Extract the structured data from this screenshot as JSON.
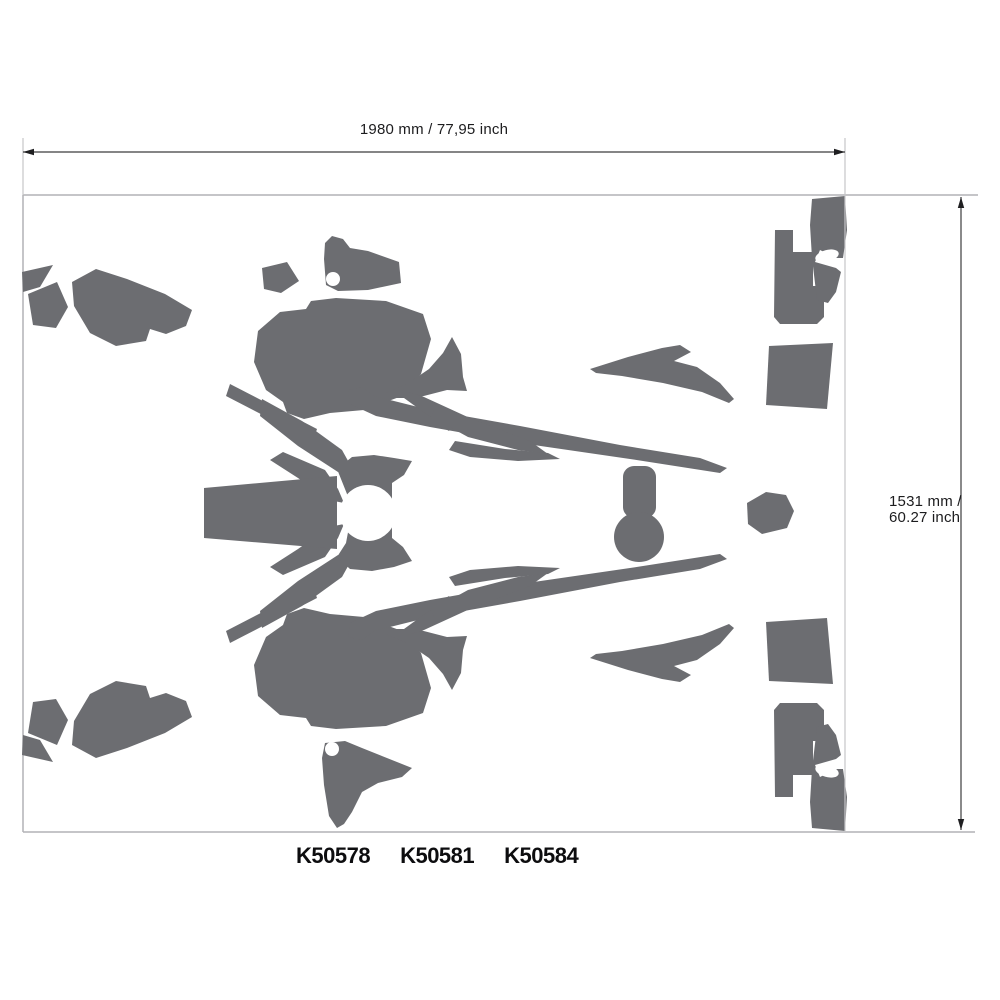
{
  "colors": {
    "decal": "#6c6d71",
    "sheet_border": "#b2b2b5",
    "ext_line": "#c6c6c8",
    "dim_line": "#3c3c3e",
    "arrow": "#1f1f21",
    "text": "#1c1c1e"
  },
  "sheet": {
    "x": 23,
    "y": 195,
    "w": 955,
    "h": 637
  },
  "dimensions": {
    "width": {
      "label": "1980 mm / 77,95 inch",
      "line": {
        "x1": 23,
        "y1": 152,
        "x2": 845,
        "y2": 152
      },
      "extensions": [
        {
          "x1": 23,
          "y1": 138,
          "x2": 23,
          "y2": 195
        },
        {
          "x1": 845,
          "y1": 138,
          "x2": 845,
          "y2": 831
        }
      ]
    },
    "height": {
      "label_line1": "1531 mm /",
      "label_line2": "60.27 inch",
      "line": {
        "x1": 961,
        "y1": 197,
        "x2": 961,
        "y2": 830
      }
    }
  },
  "part_numbers": [
    "K50578",
    "K50581",
    "K50584"
  ],
  "decal_shapes": [
    {
      "name": "left-tri",
      "type": "polygon",
      "mirror": true,
      "points": [
        [
          22,
          272
        ],
        [
          53,
          265
        ],
        [
          40,
          287
        ],
        [
          23,
          292
        ]
      ]
    },
    {
      "name": "left-quad",
      "type": "polygon",
      "mirror": true,
      "points": [
        [
          28,
          294
        ],
        [
          57,
          282
        ],
        [
          68,
          307
        ],
        [
          56,
          328
        ],
        [
          33,
          325
        ]
      ]
    },
    {
      "name": "left-fender",
      "type": "polygon",
      "mirror": true,
      "points": [
        [
          72,
          282
        ],
        [
          96,
          269
        ],
        [
          127,
          279
        ],
        [
          165,
          294
        ],
        [
          192,
          310
        ],
        [
          186,
          326
        ],
        [
          166,
          334
        ],
        [
          150,
          329
        ],
        [
          146,
          341
        ],
        [
          116,
          346
        ],
        [
          90,
          333
        ],
        [
          74,
          306
        ]
      ]
    },
    {
      "name": "mid-quad",
      "type": "polygon",
      "mirror": false,
      "points": [
        [
          262,
          268
        ],
        [
          287,
          262
        ],
        [
          299,
          281
        ],
        [
          281,
          293
        ],
        [
          264,
          289
        ]
      ]
    },
    {
      "name": "tri-hole-top",
      "type": "polygon",
      "mirror": false,
      "points": [
        [
          324,
          259
        ],
        [
          325,
          243
        ],
        [
          332,
          236
        ],
        [
          343,
          239
        ],
        [
          350,
          248
        ],
        [
          368,
          251
        ],
        [
          399,
          262
        ],
        [
          401,
          283
        ],
        [
          368,
          290
        ],
        [
          338,
          291
        ],
        [
          326,
          285
        ]
      ]
    },
    {
      "name": "tri-hole-bottom",
      "type": "polygon",
      "mirror": false,
      "points": [
        [
          325,
          743
        ],
        [
          345,
          741
        ],
        [
          362,
          748
        ],
        [
          412,
          768
        ],
        [
          402,
          777
        ],
        [
          378,
          783
        ],
        [
          362,
          792
        ],
        [
          352,
          812
        ],
        [
          344,
          824
        ],
        [
          337,
          828
        ],
        [
          329,
          816
        ],
        [
          324,
          785
        ],
        [
          322,
          758
        ]
      ]
    },
    {
      "name": "shroud-blob",
      "type": "polygon",
      "mirror": true,
      "points": [
        [
          258,
          331
        ],
        [
          280,
          312
        ],
        [
          306,
          309
        ],
        [
          311,
          301
        ],
        [
          336,
          298
        ],
        [
          386,
          301
        ],
        [
          423,
          314
        ],
        [
          431,
          339
        ],
        [
          421,
          374
        ],
        [
          402,
          396
        ],
        [
          364,
          410
        ],
        [
          330,
          413
        ],
        [
          304,
          419
        ],
        [
          287,
          413
        ],
        [
          283,
          402
        ],
        [
          266,
          390
        ],
        [
          254,
          362
        ]
      ]
    },
    {
      "name": "fork-strip",
      "type": "polygon",
      "mirror": true,
      "points": [
        [
          230,
          384
        ],
        [
          317,
          429
        ],
        [
          313,
          441
        ],
        [
          226,
          396
        ]
      ]
    },
    {
      "name": "band",
      "type": "polygon",
      "mirror": true,
      "points": [
        [
          262,
          399
        ],
        [
          302,
          421
        ],
        [
          342,
          450
        ],
        [
          352,
          468
        ],
        [
          338,
          472
        ],
        [
          298,
          446
        ],
        [
          260,
          416
        ]
      ]
    },
    {
      "name": "band-blade",
      "type": "polygon",
      "mirror": true,
      "points": [
        [
          283,
          452
        ],
        [
          325,
          470
        ],
        [
          338,
          489
        ],
        [
          344,
          503
        ],
        [
          329,
          500
        ],
        [
          298,
          478
        ],
        [
          270,
          460
        ]
      ]
    },
    {
      "name": "horn",
      "type": "polygon",
      "mirror": true,
      "points": [
        [
          452,
          337
        ],
        [
          461,
          354
        ],
        [
          463,
          377
        ],
        [
          467,
          391
        ],
        [
          447,
          390
        ],
        [
          416,
          398
        ],
        [
          389,
          398
        ],
        [
          386,
          393
        ],
        [
          407,
          384
        ],
        [
          429,
          369
        ],
        [
          443,
          353
        ]
      ]
    },
    {
      "name": "long-blade",
      "type": "polygon",
      "mirror": true,
      "points": [
        [
          348,
          390
        ],
        [
          362,
          387
        ],
        [
          374,
          396
        ],
        [
          430,
          410
        ],
        [
          520,
          426
        ],
        [
          620,
          445
        ],
        [
          700,
          458
        ],
        [
          727,
          468
        ],
        [
          720,
          473
        ],
        [
          630,
          459
        ],
        [
          520,
          443
        ],
        [
          430,
          427
        ],
        [
          376,
          416
        ],
        [
          350,
          404
        ]
      ]
    },
    {
      "name": "inner-blade",
      "type": "polygon",
      "mirror": true,
      "points": [
        [
          408,
          392
        ],
        [
          424,
          397
        ],
        [
          472,
          419
        ],
        [
          530,
          441
        ],
        [
          548,
          454
        ],
        [
          518,
          450
        ],
        [
          468,
          437
        ],
        [
          426,
          414
        ],
        [
          404,
          398
        ]
      ]
    },
    {
      "name": "shard-a",
      "type": "polygon",
      "mirror": true,
      "points": [
        [
          436,
          403
        ],
        [
          458,
          413
        ],
        [
          449,
          431
        ],
        [
          431,
          419
        ]
      ]
    },
    {
      "name": "shard-b",
      "type": "polygon",
      "mirror": true,
      "points": [
        [
          455,
          441
        ],
        [
          505,
          449
        ],
        [
          548,
          453
        ],
        [
          560,
          459
        ],
        [
          518,
          461
        ],
        [
          470,
          457
        ],
        [
          449,
          450
        ]
      ]
    },
    {
      "name": "front-fender",
      "type": "polygon",
      "mirror": false,
      "points": [
        [
          204,
          488
        ],
        [
          337,
          476
        ],
        [
          337,
          549
        ],
        [
          204,
          538
        ]
      ]
    },
    {
      "name": "headlight-ring",
      "type": "polygon",
      "mirror": false,
      "points": [
        [
          337,
          469
        ],
        [
          352,
          457
        ],
        [
          374,
          455
        ],
        [
          394,
          458
        ],
        [
          412,
          461
        ],
        [
          404,
          475
        ],
        [
          392,
          483
        ],
        [
          392,
          538
        ],
        [
          403,
          547
        ],
        [
          412,
          561
        ],
        [
          394,
          567
        ],
        [
          372,
          571
        ],
        [
          350,
          569
        ],
        [
          337,
          557
        ],
        [
          346,
          543
        ],
        [
          349,
          527
        ],
        [
          349,
          499
        ],
        [
          343,
          484
        ]
      ]
    },
    {
      "name": "keyhole-stem",
      "type": "rect",
      "mirror": false,
      "x": 623,
      "y": 466,
      "w": 33,
      "h": 52,
      "rx": 11
    },
    {
      "name": "keyhole-ball",
      "type": "circle",
      "mirror": false,
      "cx": 639,
      "cy": 537,
      "r": 25
    },
    {
      "name": "pentagon",
      "type": "polygon",
      "mirror": false,
      "points": [
        [
          747,
          503
        ],
        [
          766,
          492
        ],
        [
          786,
          495
        ],
        [
          794,
          511
        ],
        [
          787,
          528
        ],
        [
          762,
          534
        ],
        [
          748,
          524
        ]
      ]
    },
    {
      "name": "wavy-blade",
      "type": "polygon",
      "mirror": true,
      "points": [
        [
          590,
          369
        ],
        [
          628,
          357
        ],
        [
          662,
          348
        ],
        [
          680,
          345
        ],
        [
          691,
          352
        ],
        [
          674,
          361
        ],
        [
          697,
          367
        ],
        [
          720,
          383
        ],
        [
          734,
          399
        ],
        [
          729,
          403
        ],
        [
          702,
          392
        ],
        [
          663,
          383
        ],
        [
          622,
          376
        ],
        [
          596,
          373
        ]
      ]
    },
    {
      "name": "corner-l",
      "type": "polygon",
      "mirror": true,
      "points": [
        [
          775,
          230
        ],
        [
          793,
          230
        ],
        [
          793,
          252
        ],
        [
          813,
          252
        ],
        [
          813,
          286
        ],
        [
          824,
          286
        ],
        [
          824,
          317
        ],
        [
          817,
          324
        ],
        [
          780,
          324
        ],
        [
          774,
          317
        ]
      ]
    },
    {
      "name": "corner-sliver",
      "type": "polygon",
      "mirror": true,
      "points": [
        [
          812,
          199
        ],
        [
          845,
          196
        ],
        [
          847,
          230
        ],
        [
          843,
          258
        ],
        [
          836,
          258
        ],
        [
          820,
          250
        ],
        [
          815,
          262
        ],
        [
          836,
          268
        ],
        [
          841,
          272
        ],
        [
          836,
          292
        ],
        [
          828,
          303
        ],
        [
          817,
          300
        ],
        [
          812,
          258
        ],
        [
          810,
          225
        ]
      ]
    },
    {
      "name": "right-trap",
      "type": "polygon",
      "mirror": true,
      "points": [
        [
          769,
          346
        ],
        [
          833,
          343
        ],
        [
          827,
          409
        ],
        [
          766,
          405
        ]
      ]
    }
  ],
  "cutouts": [
    {
      "name": "tri-hole-top-hole",
      "type": "circle",
      "mirror": false,
      "cx": 333,
      "cy": 279,
      "r": 7
    },
    {
      "name": "tri-hole-bottom-hole",
      "type": "circle",
      "mirror": false,
      "cx": 332,
      "cy": 749,
      "r": 7
    },
    {
      "name": "headlight-circle",
      "type": "circle",
      "mirror": false,
      "cx": 368,
      "cy": 513,
      "r": 28
    },
    {
      "name": "sliver-ellipse",
      "type": "ellipse",
      "mirror": true,
      "cx": 827,
      "cy": 256,
      "rx": 12,
      "ry": 6,
      "rot": -15
    }
  ]
}
